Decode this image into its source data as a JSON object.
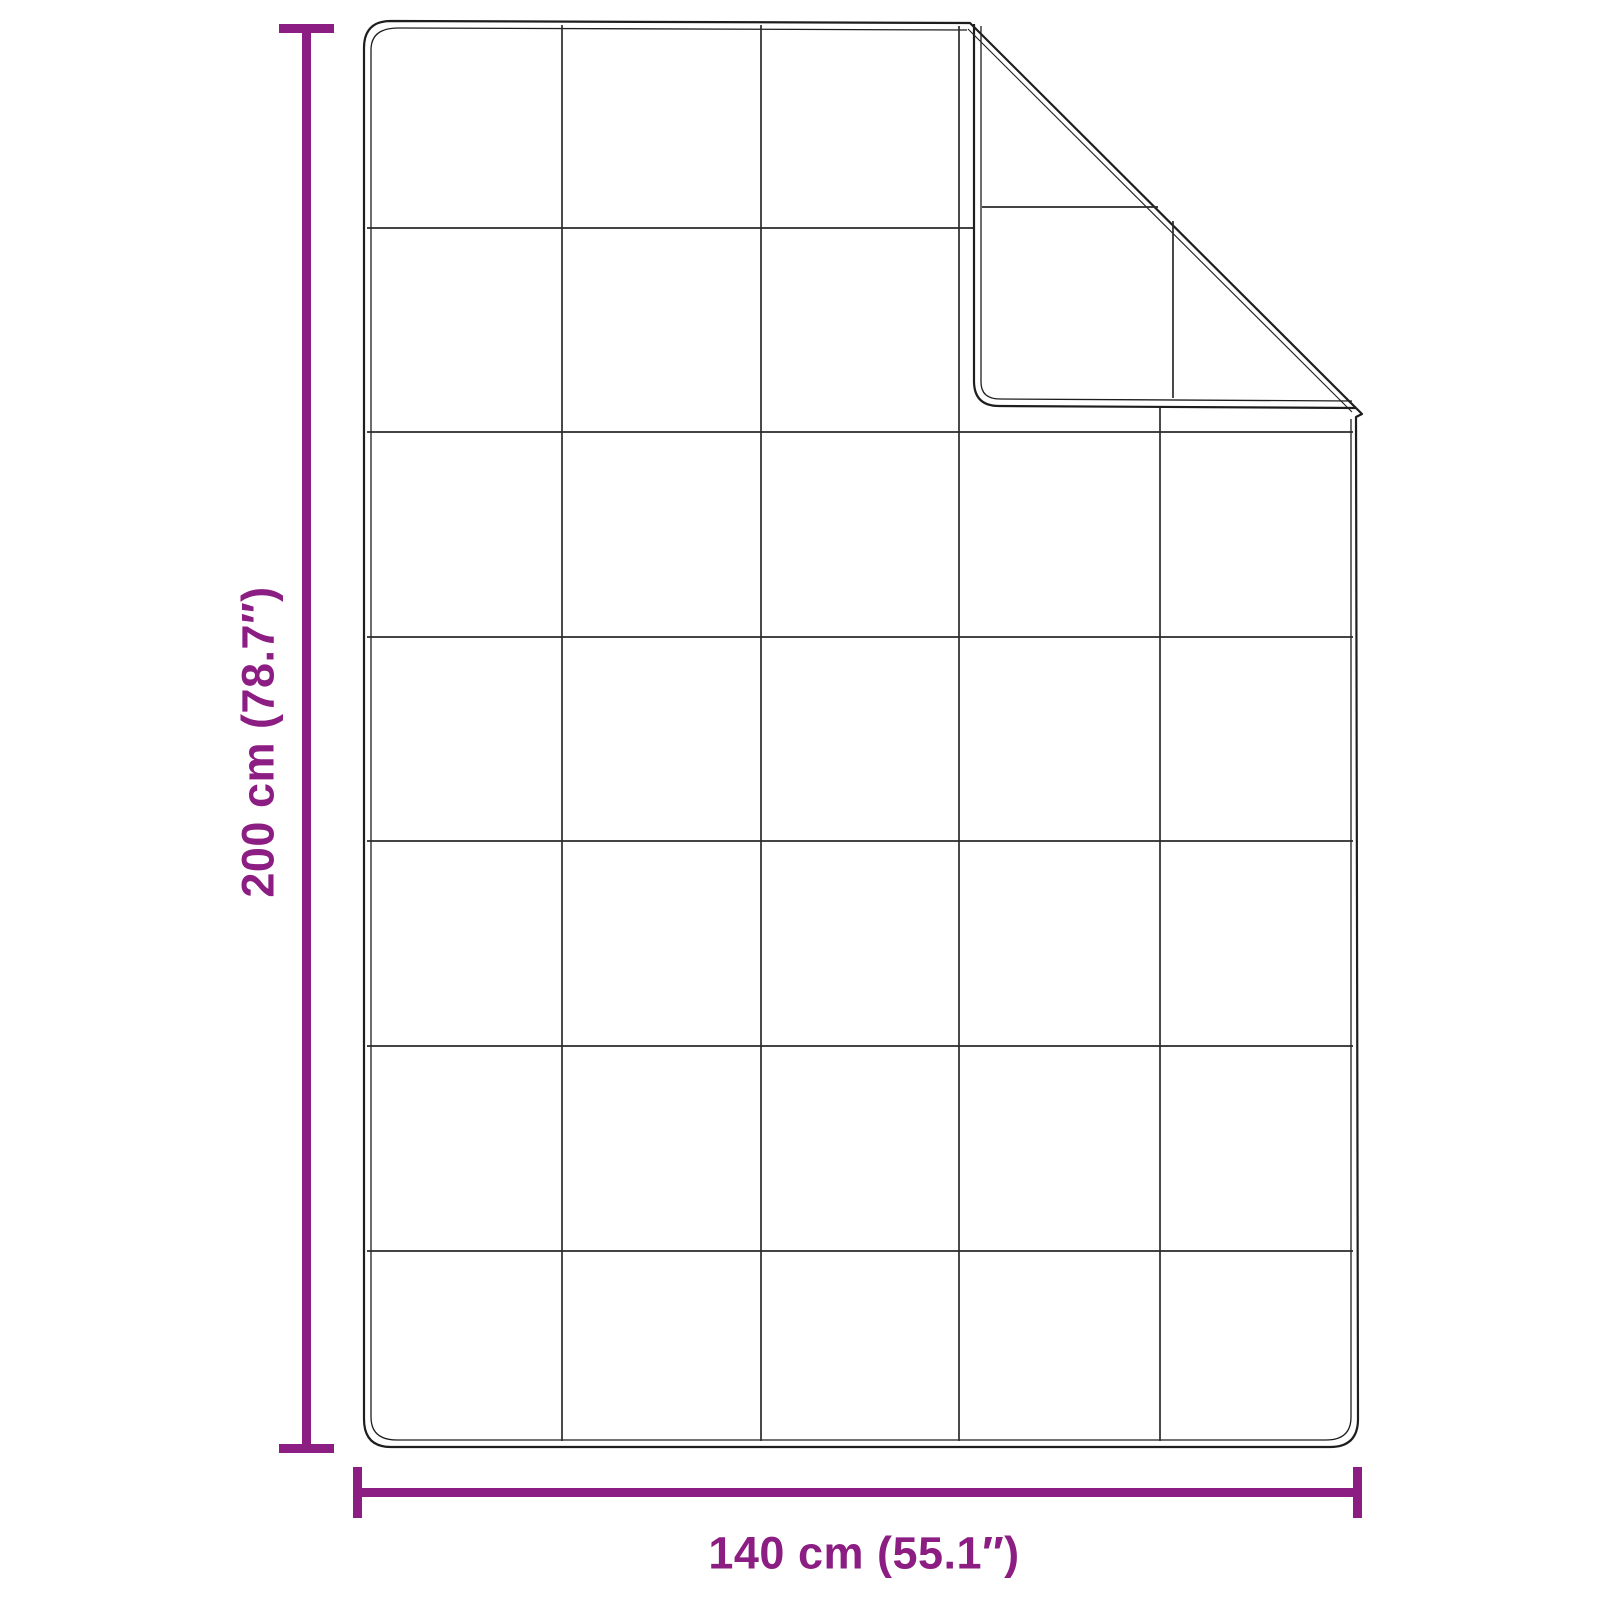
{
  "diagram": {
    "height_label": "200 cm (78.7″)",
    "width_label": "140 cm (55.1″)",
    "accent_color": "#8C1D82",
    "outline_color": "#1e1e1e",
    "background_color": "#ffffff",
    "grid_columns": 5,
    "grid_rows": 7
  }
}
